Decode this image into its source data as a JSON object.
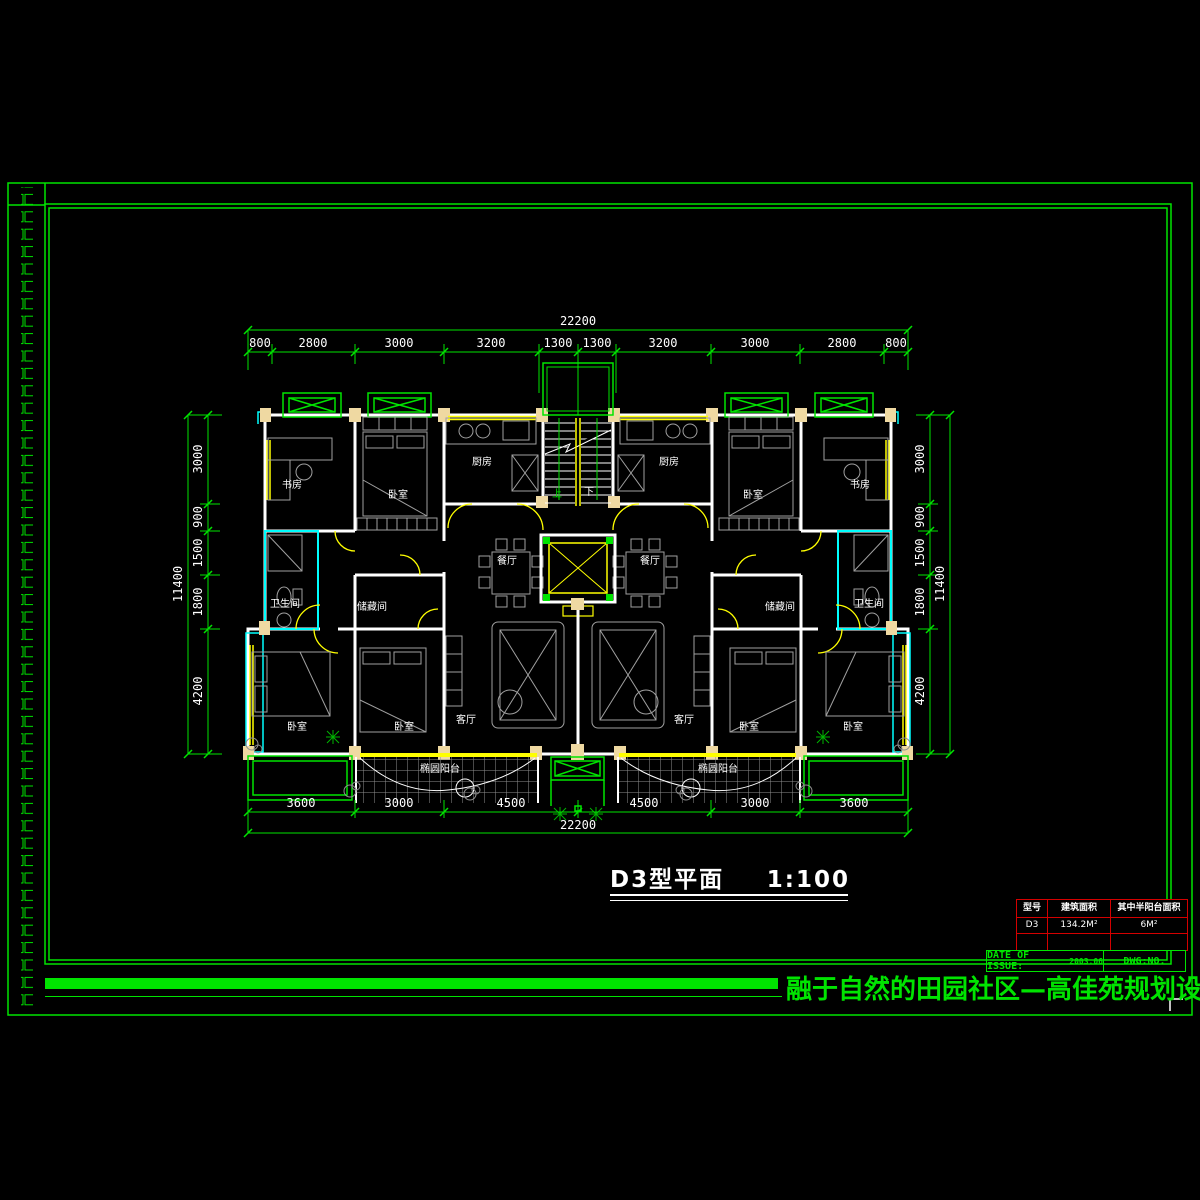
{
  "colors": {
    "line_green": "#00e400",
    "bright_green": "#00ff00",
    "wall_white": "#ffffff",
    "fixture_cyan": "#00ffff",
    "window_yellow": "#ffff00",
    "column_tan": "#efd9a2",
    "furniture_gray": "#a0a0a0",
    "table_red": "#d40000",
    "background": "#000000"
  },
  "dimensions": {
    "top_total": "22200",
    "top_segments": [
      "800",
      "2800",
      "3000",
      "3200",
      "1300",
      "1300",
      "3200",
      "3000",
      "2800",
      "800"
    ],
    "bottom_segments": [
      "3600",
      "3000",
      "4500",
      "4500",
      "3000",
      "3600"
    ],
    "bottom_total": "22200",
    "left_total": "11400",
    "left_segments": [
      "3000",
      "900",
      "1500",
      "1800",
      "4200"
    ],
    "right_total": "11400",
    "right_segments": [
      "3000",
      "900",
      "1500",
      "1800",
      "4200"
    ]
  },
  "plan": {
    "room_labels": [
      "书房",
      "卧室",
      "厨房",
      "卫生间",
      "储藏间",
      "餐厅",
      "客厅",
      "卧室",
      "卧室",
      "椭圆阳台",
      "厨房",
      "卧室",
      "书房",
      "储藏间",
      "卫生间",
      "餐厅",
      "客厅",
      "卧室",
      "卧室",
      "椭圆阳台"
    ],
    "stair": {
      "up": "上",
      "down": "下"
    }
  },
  "title_block": {
    "name": "D3型平面",
    "scale": "1:100"
  },
  "info_table": {
    "headers": [
      "型号",
      "建筑面积",
      "其中半阳台面积"
    ],
    "row": [
      "D3",
      "134.2M²",
      "6M²"
    ]
  },
  "footer": {
    "date_label": "DATE OF ISSUE:",
    "date_value": "2003.06",
    "dwg_label": "DWG:NO."
  },
  "banner": {
    "text": "融于自然的田园社区—高佳苑规划设计方案"
  }
}
